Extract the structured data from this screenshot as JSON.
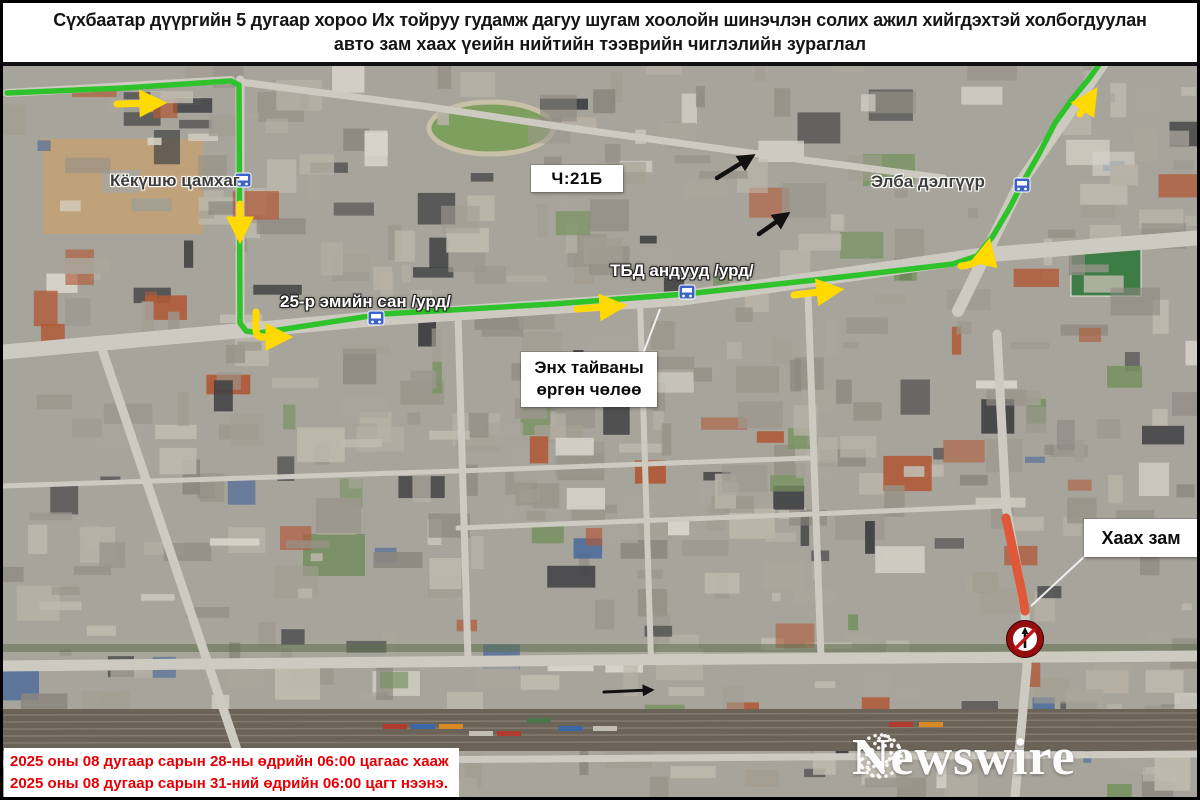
{
  "title": {
    "line1": "Сүхбаатар дүүргийн 5 дугаар хороо Их тойруу гудамж дагуу шугам хоолойн шинэчлэн солих ажил хийгдэхтэй холбогдуулан",
    "line2": "авто зам хаах үеийн нийтийн тээврийн чиглэлийн зураглал"
  },
  "map": {
    "labels": {
      "stop_kokushu": "Кёкүшю цамхаг",
      "stop_pharmacy": "25-р эмийн сан /урд/",
      "stop_tbd": "ТБД андууд /урд/",
      "stop_elba": "Элба дэлгүүр",
      "route_number": "Ч:21Б",
      "street_line1": "Энх тайваны",
      "street_line2": "өргөн чөлөө",
      "closed_road": "Хаах зам"
    },
    "colors": {
      "route_green": "#2fc32b",
      "arrow_yellow": "#ffd900",
      "closed_red": "#e0583a",
      "sign_ring": "#960d0d",
      "bus_icon_blue": "#3b63c8"
    }
  },
  "notice": {
    "line1": "2025 оны 08 дугаар сарын 28-ны өдрийн 06:00 цагаас хааж",
    "line2": "2025 оны 08 дугаар сарын 31-ний өдрийн 06:00 цагт нээнэ."
  },
  "watermark": {
    "brand": "Newswire"
  }
}
